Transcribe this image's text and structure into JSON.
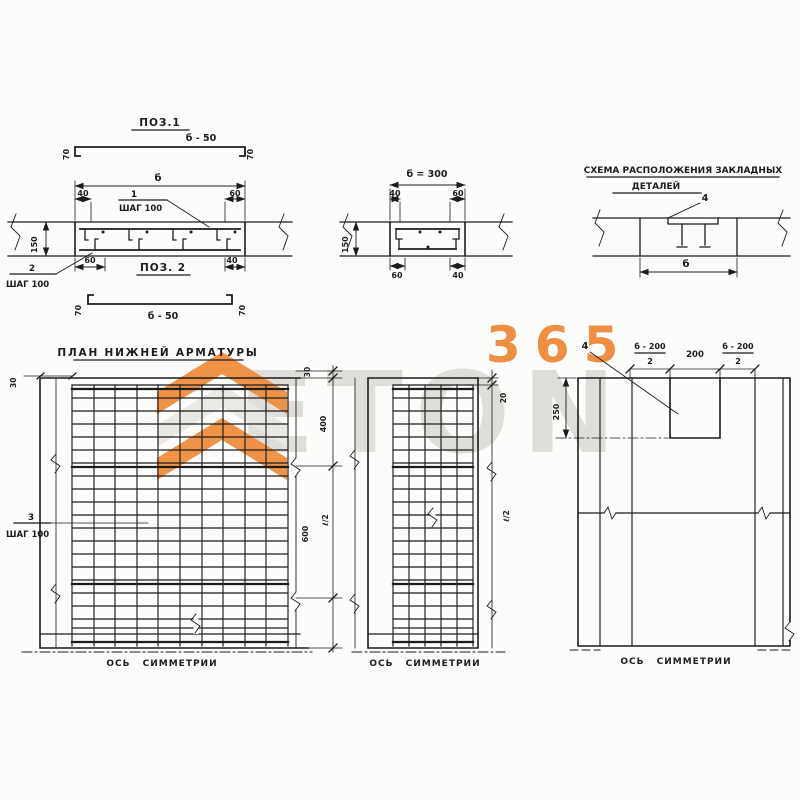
{
  "palette": {
    "paper": "#fcfcfb",
    "ink": "#1c1c1c",
    "orange": "#ee8a3a",
    "watermark_gray": "#dcdbd7"
  },
  "watermark": {
    "brand": "ETON",
    "number": "365"
  },
  "top_left": {
    "pos1_title": "ПОЗ.1",
    "pos1_length": "б - 50",
    "pos1_hook_left": "70",
    "pos1_hook_right": "70",
    "sec_width": "б",
    "sec_dim_tl": "40",
    "sec_dim_tr": "60",
    "bar1_num": "1",
    "bar1_step": "ШАГ 100",
    "sec_height": "150",
    "bar2_num": "2",
    "bar2_step": "ШАГ 100",
    "sec_dim_bl": "60",
    "sec_dim_br": "40",
    "pos2_title": "ПОЗ. 2",
    "pos2_length": "б - 50",
    "pos2_hook_left": "70",
    "pos2_hook_right": "70"
  },
  "top_mid": {
    "width": "б = 300",
    "dim_tl": "40",
    "dim_tr": "60",
    "height": "150",
    "dim_bl": "60",
    "dim_br": "40"
  },
  "top_right": {
    "title1": "СХЕМА РАСПОЛОЖЕНИЯ ЗАКЛАДНЫХ",
    "title2": "ДЕТАЛЕЙ",
    "item": "4",
    "width": "б"
  },
  "plan_left": {
    "title": "ПЛАН НИЖНЕЙ АРМАТУРЫ",
    "edge_top": "30",
    "chain_30": "30",
    "chain_400": "400",
    "chain_600": "600",
    "half_length": "ℓ/2",
    "bar3_num": "3",
    "bar3_step": "ШАГ 100",
    "axis": "ОСЬ СИММЕТРИИ"
  },
  "plan_mid": {
    "edge_top": "20",
    "half_length": "ℓ/2",
    "axis": "ОСЬ СИММЕТРИИ"
  },
  "plan_right": {
    "item": "4",
    "frac_left_num": "б - 200",
    "frac_left_den": "2",
    "span_mid": "200",
    "frac_right_num": "б - 200",
    "frac_right_den": "2",
    "notch_depth": "250",
    "axis": "ОСЬ СИММЕТРИИ"
  }
}
